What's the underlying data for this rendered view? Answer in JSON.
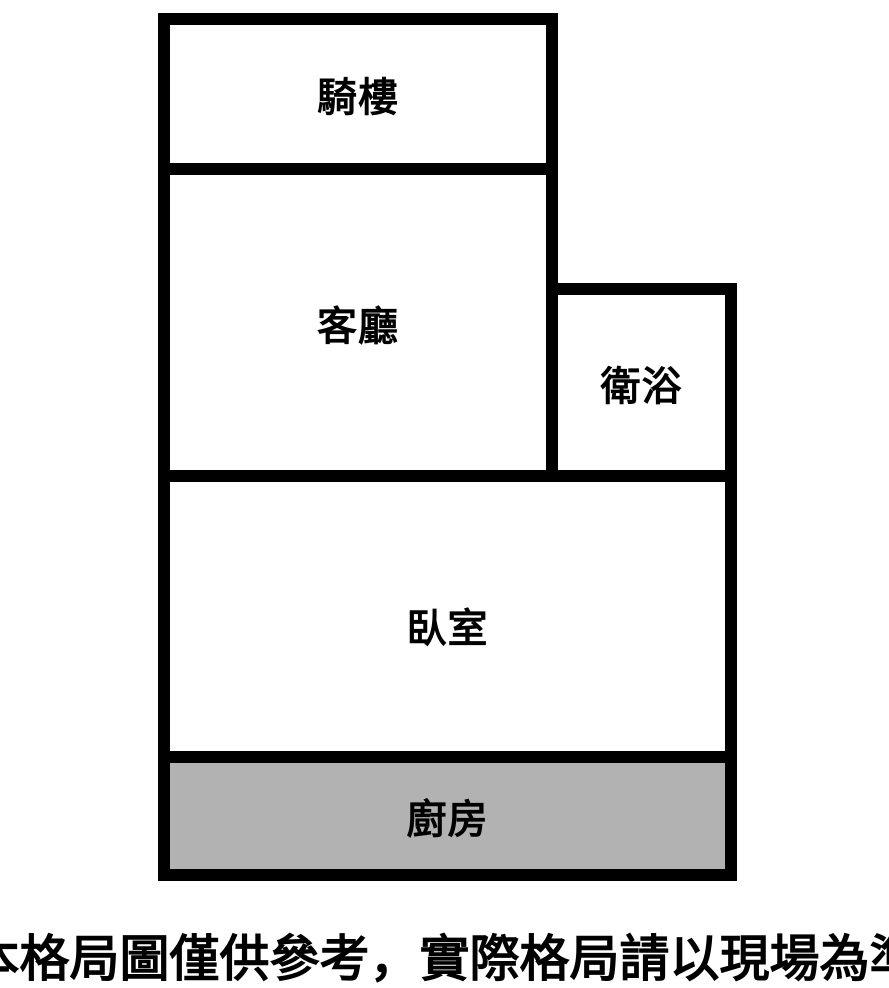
{
  "floorplan": {
    "rooms": {
      "arcade": {
        "label": "騎樓"
      },
      "living_room": {
        "label": "客廳"
      },
      "bathroom": {
        "label": "衛浴"
      },
      "bedroom": {
        "label": "臥室"
      },
      "kitchen": {
        "label": "廚房"
      }
    },
    "colors": {
      "wall": "#000000",
      "kitchen_fill": "#b2b2b2",
      "background": "#ffffff",
      "label_text": "#000000"
    }
  },
  "caption": {
    "text": "本格局圖僅供參考，實際格局請以現場為準"
  }
}
